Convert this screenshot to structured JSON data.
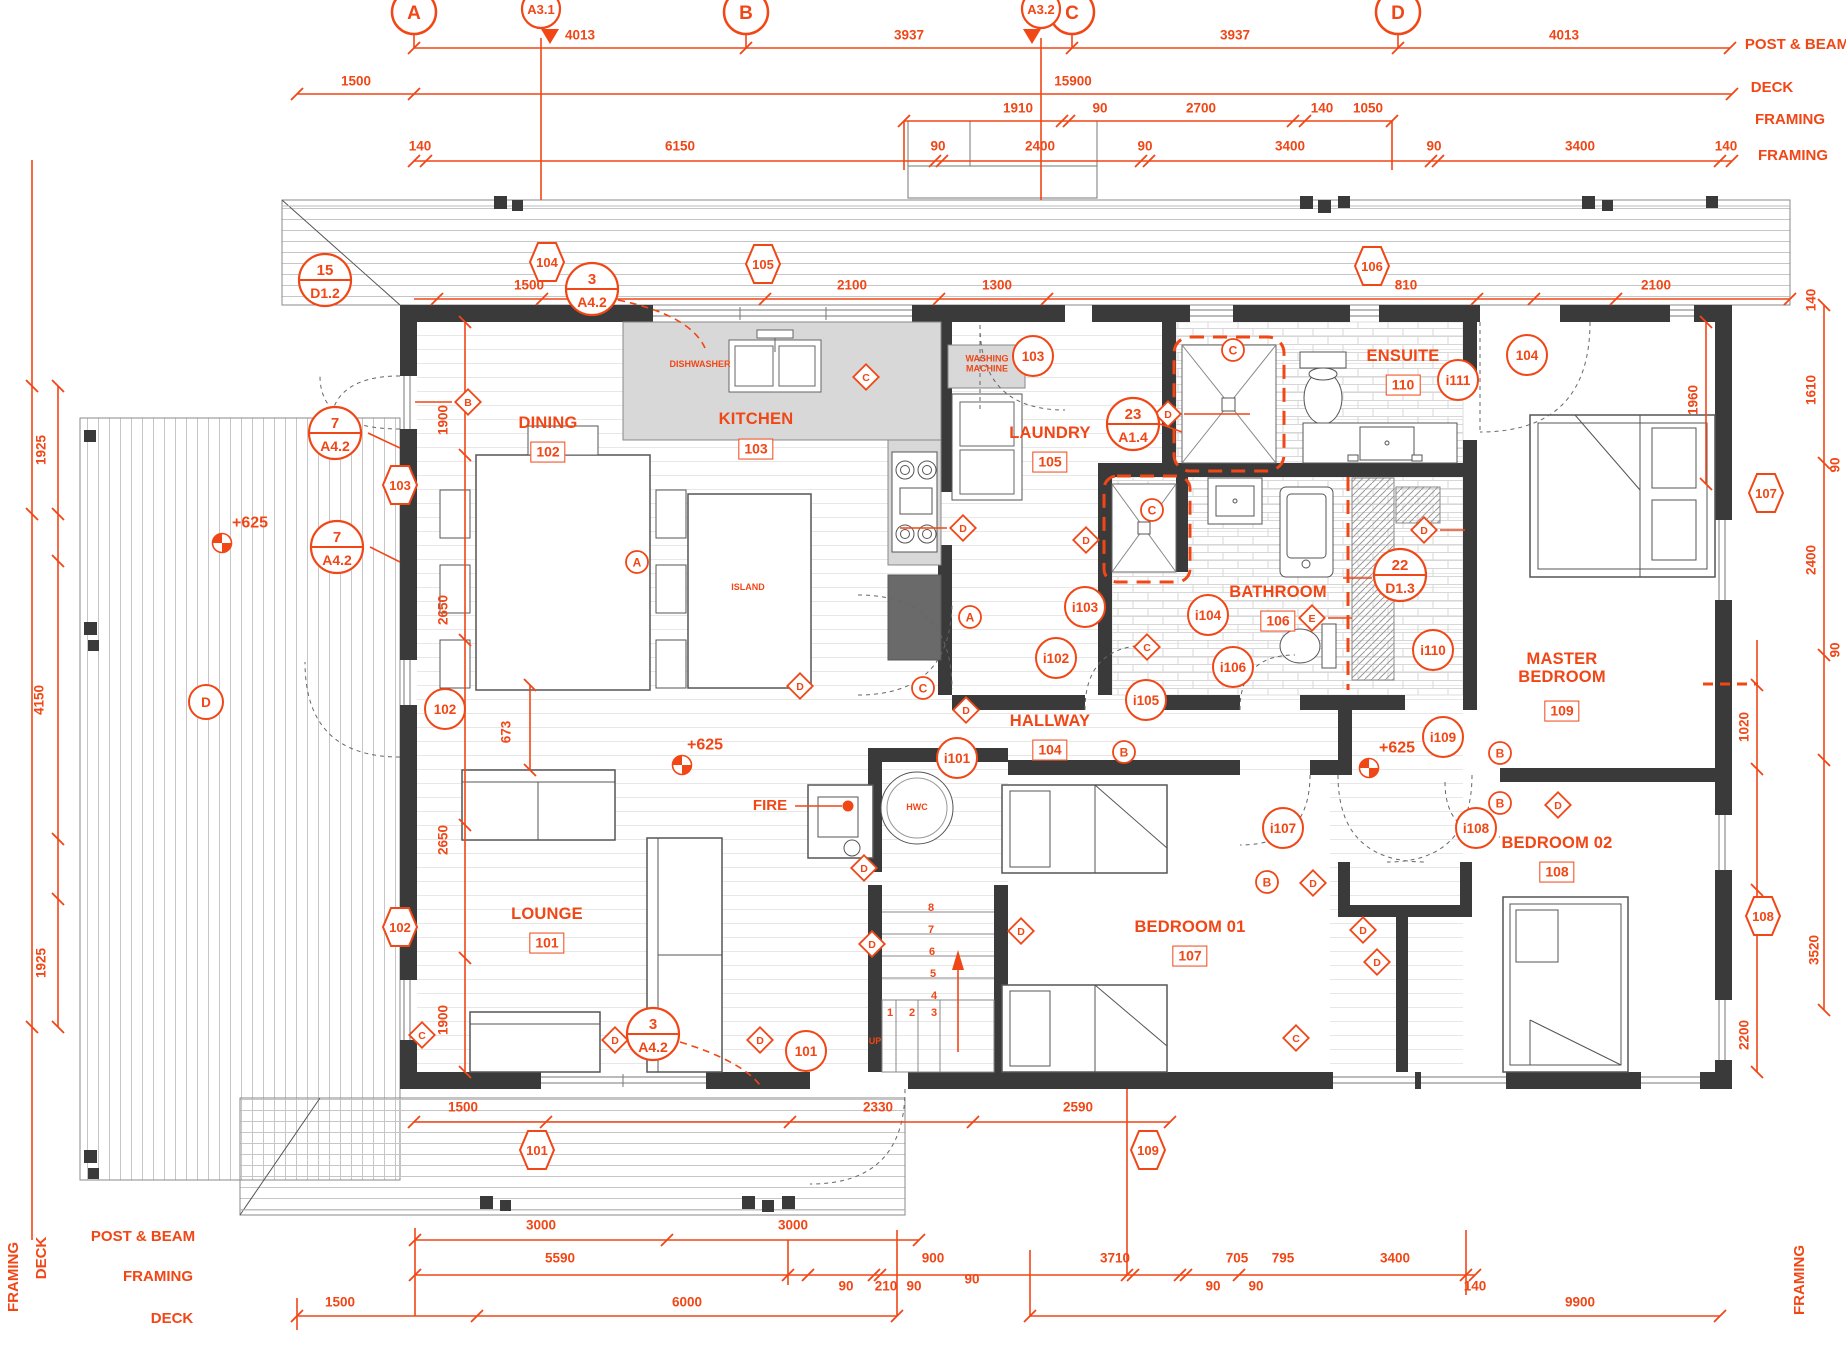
{
  "colors": {
    "accent": "#f14616",
    "wall": "#3a3a3a",
    "counter": "#d8d8d8",
    "plank": "#c6c6c6"
  },
  "annotations": [
    [
      "g",
      "A",
      414
    ],
    [
      "g",
      "B",
      746
    ],
    [
      "g",
      "C",
      1072
    ],
    [
      "g",
      "D",
      1398
    ],
    [
      "s",
      "A3.1",
      541,
      1
    ],
    [
      "s",
      "A3.2",
      1041,
      -1
    ],
    [
      "d",
      "4013",
      580,
      36
    ],
    [
      "d",
      "3937",
      909,
      36
    ],
    [
      "d",
      "3937",
      1235,
      36
    ],
    [
      "d",
      "4013",
      1564,
      36
    ],
    [
      "d",
      "1500",
      356,
      82
    ],
    [
      "d",
      "15900",
      1073,
      82
    ],
    [
      "d",
      "1910",
      1018,
      109
    ],
    [
      "d",
      "90",
      1100,
      109
    ],
    [
      "d",
      "2700",
      1201,
      109
    ],
    [
      "d",
      "140",
      1322,
      109
    ],
    [
      "d",
      "1050",
      1368,
      109
    ],
    [
      "d",
      "140",
      420,
      147
    ],
    [
      "d",
      "6150",
      680,
      147
    ],
    [
      "d",
      "90",
      938,
      147
    ],
    [
      "d",
      "2400",
      1040,
      147
    ],
    [
      "d",
      "90",
      1145,
      147
    ],
    [
      "d",
      "3400",
      1290,
      147
    ],
    [
      "d",
      "90",
      1434,
      147
    ],
    [
      "d",
      "3400",
      1580,
      147
    ],
    [
      "d",
      "140",
      1726,
      147
    ],
    [
      "t",
      "POST & BEAM",
      "hdr",
      1797,
      45
    ],
    [
      "t",
      "DECK",
      "hdr",
      1772,
      88
    ],
    [
      "t",
      "FRAMING",
      "hdr",
      1790,
      120
    ],
    [
      "t",
      "FRAMING",
      "hdr",
      1793,
      156
    ],
    [
      "d",
      "1500",
      529,
      286
    ],
    [
      "d",
      "2100",
      852,
      286
    ],
    [
      "d",
      "1300",
      997,
      286
    ],
    [
      "d",
      "810",
      1406,
      286
    ],
    [
      "d",
      "2100",
      1656,
      286
    ],
    [
      "dv",
      "1925",
      42,
      450
    ],
    [
      "dv",
      "4150",
      40,
      700
    ],
    [
      "dv",
      "1925",
      42,
      963
    ],
    [
      "dv",
      "1900",
      444,
      420
    ],
    [
      "dv",
      "2650",
      444,
      610
    ],
    [
      "dv",
      "2650",
      444,
      840
    ],
    [
      "dv",
      "1900",
      444,
      1020
    ],
    [
      "dv",
      "673",
      507,
      732
    ],
    [
      "dv",
      "1960",
      1694,
      400
    ],
    [
      "dv",
      "140",
      1812,
      300
    ],
    [
      "dv",
      "1610",
      1812,
      390
    ],
    [
      "dv",
      "90",
      1836,
      465
    ],
    [
      "dv",
      "2400",
      1812,
      560
    ],
    [
      "dv",
      "90",
      1836,
      650
    ],
    [
      "dv",
      "1020",
      1745,
      727
    ],
    [
      "dv",
      "3520",
      1815,
      950
    ],
    [
      "dv",
      "2200",
      1745,
      1035
    ],
    [
      "room",
      "DINING",
      "102",
      548,
      424,
      452
    ],
    [
      "room",
      "KITCHEN",
      "103",
      756,
      420,
      449
    ],
    [
      "room",
      "LAUNDRY",
      "105",
      1050,
      434,
      462
    ],
    [
      "room",
      "ENSUITE",
      "110",
      1403,
      357,
      385
    ],
    [
      "room",
      "BATHROOM",
      "106",
      1278,
      593,
      621
    ],
    [
      "room",
      "HALLWAY",
      "104",
      1050,
      722,
      750
    ],
    [
      "room",
      "MASTER\nBEDROOM",
      "109",
      1562,
      669,
      711
    ],
    [
      "room",
      "BEDROOM 02",
      "108",
      1557,
      844,
      872
    ],
    [
      "room",
      "BEDROOM 01",
      "107",
      1190,
      928,
      956
    ],
    [
      "room",
      "LOUNGE",
      "101",
      547,
      915,
      943
    ],
    [
      "t",
      "DISHWASHER",
      "small",
      700,
      365
    ],
    [
      "t",
      "WASHING\nMACHINE",
      "small",
      987,
      364
    ],
    [
      "t",
      "ISLAND",
      "small",
      748,
      588
    ],
    [
      "t",
      "HWC",
      "small",
      917,
      808
    ],
    [
      "t",
      "FIRE",
      "fire",
      770,
      806
    ],
    [
      "t",
      "UP",
      "small",
      875,
      1042
    ],
    [
      "t",
      "1",
      "snum",
      890,
      1014
    ],
    [
      "t",
      "2",
      "snum",
      912,
      1014
    ],
    [
      "t",
      "3",
      "snum",
      934,
      1014
    ],
    [
      "t",
      "4",
      "snum",
      934,
      997
    ],
    [
      "t",
      "5",
      "snum",
      933,
      975
    ],
    [
      "t",
      "6",
      "snum",
      932,
      953
    ],
    [
      "t",
      "7",
      "snum",
      931,
      931
    ],
    [
      "t",
      "8",
      "snum",
      931,
      909
    ],
    [
      "hex",
      "104",
      547,
      262
    ],
    [
      "hex",
      "105",
      763,
      264
    ],
    [
      "hex",
      "106",
      1372,
      266
    ],
    [
      "hex",
      "103",
      400,
      485
    ],
    [
      "hex",
      "102",
      400,
      927
    ],
    [
      "hex",
      "101",
      537,
      1150
    ],
    [
      "hex",
      "109",
      1148,
      1150
    ],
    [
      "hex",
      "107",
      1766,
      493
    ],
    [
      "hex",
      "108",
      1763,
      916
    ],
    [
      "c",
      "103",
      1033,
      356
    ],
    [
      "c",
      "104",
      1527,
      355
    ],
    [
      "c",
      "102",
      445,
      709
    ],
    [
      "c",
      "101",
      806,
      1051
    ],
    [
      "c",
      "i111",
      1458,
      380
    ],
    [
      "c",
      "i110",
      1433,
      650
    ],
    [
      "c",
      "i109",
      1443,
      737
    ],
    [
      "c",
      "i108",
      1476,
      828
    ],
    [
      "c",
      "i107",
      1283,
      828
    ],
    [
      "c",
      "i106",
      1233,
      667
    ],
    [
      "c",
      "i105",
      1146,
      700
    ],
    [
      "c",
      "i104",
      1208,
      615
    ],
    [
      "c",
      "i103",
      1085,
      607
    ],
    [
      "c",
      "i102",
      1056,
      658
    ],
    [
      "c",
      "i101",
      957,
      758
    ],
    [
      "cd",
      "D",
      206,
      702
    ],
    [
      "cl",
      "A",
      637,
      562
    ],
    [
      "cl",
      "A",
      970,
      617
    ],
    [
      "cl",
      "B",
      1124,
      752
    ],
    [
      "cl",
      "B",
      1500,
      753
    ],
    [
      "cl",
      "B",
      1500,
      803
    ],
    [
      "cl",
      "B",
      1267,
      882
    ],
    [
      "cl",
      "C",
      1233,
      350
    ],
    [
      "cl",
      "C",
      1152,
      510
    ],
    [
      "cl",
      "C",
      923,
      688
    ],
    [
      "dm",
      "B",
      468,
      402
    ],
    [
      "dm",
      "C",
      866,
      377
    ],
    [
      "dm",
      "C",
      1147,
      647
    ],
    [
      "dm",
      "C",
      1296,
      1038
    ],
    [
      "dm",
      "C",
      422,
      1035
    ],
    [
      "dm",
      "D",
      963,
      528
    ],
    [
      "dm",
      "D",
      1086,
      540
    ],
    [
      "dm",
      "D",
      1168,
      414
    ],
    [
      "dm",
      "D",
      966,
      710
    ],
    [
      "dm",
      "D",
      800,
      686
    ],
    [
      "dm",
      "D",
      864,
      868
    ],
    [
      "dm",
      "D",
      872,
      944
    ],
    [
      "dm",
      "D",
      1021,
      931
    ],
    [
      "dm",
      "D",
      615,
      1040
    ],
    [
      "dm",
      "D",
      760,
      1040
    ],
    [
      "dm",
      "D",
      1313,
      883
    ],
    [
      "dm",
      "D",
      1363,
      930
    ],
    [
      "dm",
      "D",
      1377,
      962
    ],
    [
      "dm",
      "D",
      1558,
      805
    ],
    [
      "dm",
      "D",
      1424,
      530
    ],
    [
      "dm",
      "E",
      1312,
      618
    ],
    [
      "bb",
      "15",
      "D1.2",
      325,
      280
    ],
    [
      "bb",
      "3",
      "A4.2",
      592,
      289
    ],
    [
      "bb",
      "7",
      "A4.2",
      335,
      433
    ],
    [
      "bb",
      "7",
      "A4.2",
      337,
      547
    ],
    [
      "bb",
      "23",
      "A1.4",
      1133,
      424
    ],
    [
      "bb",
      "22",
      "D1.3",
      1400,
      575
    ],
    [
      "bb",
      "3",
      "A4.2",
      653,
      1034
    ],
    [
      "lv",
      "+625",
      705,
      745,
      682,
      765
    ],
    [
      "lv",
      "+625",
      1397,
      748,
      1369,
      768
    ],
    [
      "lv",
      "+625",
      250,
      523,
      222,
      543
    ],
    [
      "d",
      "1500",
      463,
      1108
    ],
    [
      "d",
      "2330",
      878,
      1108
    ],
    [
      "d",
      "2590",
      1078,
      1108
    ],
    [
      "d",
      "3000",
      541,
      1226
    ],
    [
      "d",
      "3000",
      793,
      1226
    ],
    [
      "d",
      "5590",
      560,
      1259
    ],
    [
      "d",
      "900",
      933,
      1259
    ],
    [
      "d",
      "3710",
      1115,
      1259
    ],
    [
      "d",
      "705",
      1237,
      1259
    ],
    [
      "d",
      "795",
      1283,
      1259
    ],
    [
      "d",
      "3400",
      1395,
      1259
    ],
    [
      "d",
      "90",
      846,
      1287
    ],
    [
      "d",
      "210",
      886,
      1287
    ],
    [
      "d",
      "90",
      914,
      1287
    ],
    [
      "d",
      "90",
      972,
      1280
    ],
    [
      "d",
      "90",
      1213,
      1287
    ],
    [
      "d",
      "90",
      1256,
      1287
    ],
    [
      "d",
      "140",
      1475,
      1287
    ],
    [
      "d",
      "1500",
      340,
      1303
    ],
    [
      "d",
      "6000",
      687,
      1303
    ],
    [
      "d",
      "9900",
      1580,
      1303
    ],
    [
      "t",
      "POST & BEAM",
      "hdr",
      143,
      1237
    ],
    [
      "t",
      "FRAMING",
      "hdr",
      158,
      1277
    ],
    [
      "t",
      "DECK",
      "hdr",
      172,
      1319
    ],
    [
      "tv",
      "FRAMING",
      "hdr",
      14,
      1277
    ],
    [
      "tv",
      "DECK",
      "hdr",
      42,
      1258
    ],
    [
      "tv",
      "FRAMING",
      "hdr",
      1800,
      1280
    ]
  ]
}
